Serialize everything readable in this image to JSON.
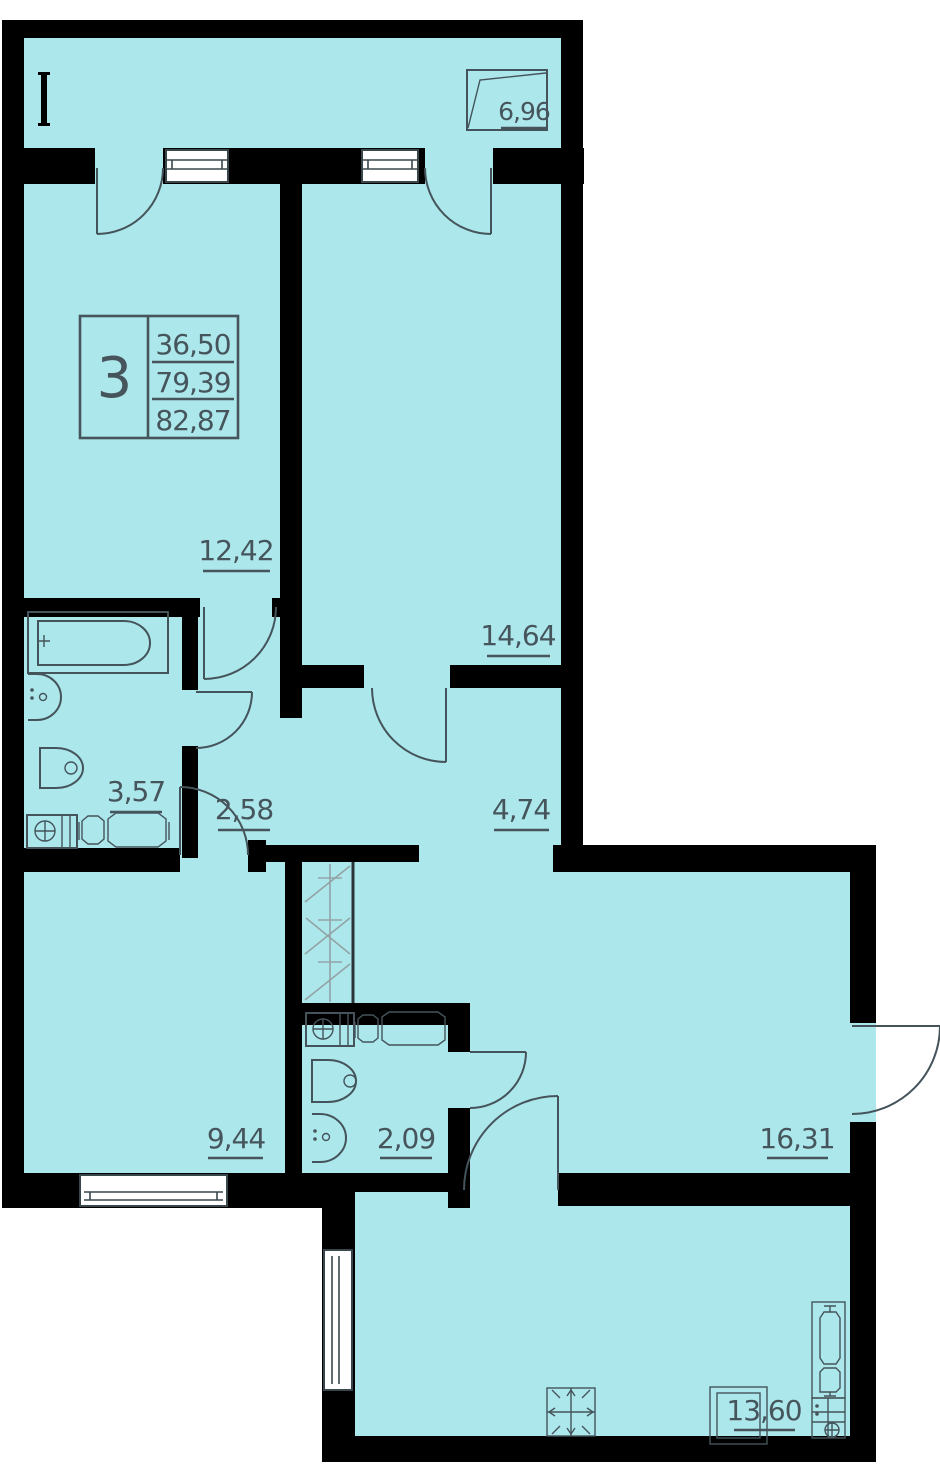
{
  "plan": {
    "type": "apartment-floor-plan",
    "colors": {
      "floor": "#ace7ec",
      "walls": "#000000",
      "lines": "#44545a",
      "background": "#ffffff"
    },
    "legend": {
      "room_count": "3",
      "living_area": "36,50",
      "floor_area": "79,39",
      "total_area": "82,87"
    },
    "rooms": {
      "balcony": "6,96",
      "bedroom_top_left": "12,42",
      "bedroom_top_right": "14,64",
      "bathroom": "3,57",
      "corridor": "2,58",
      "hallway": "4,74",
      "bedroom_bottom_left": "9,44",
      "wc": "2,09",
      "living_room": "16,31",
      "kitchen": "13,60"
    }
  }
}
